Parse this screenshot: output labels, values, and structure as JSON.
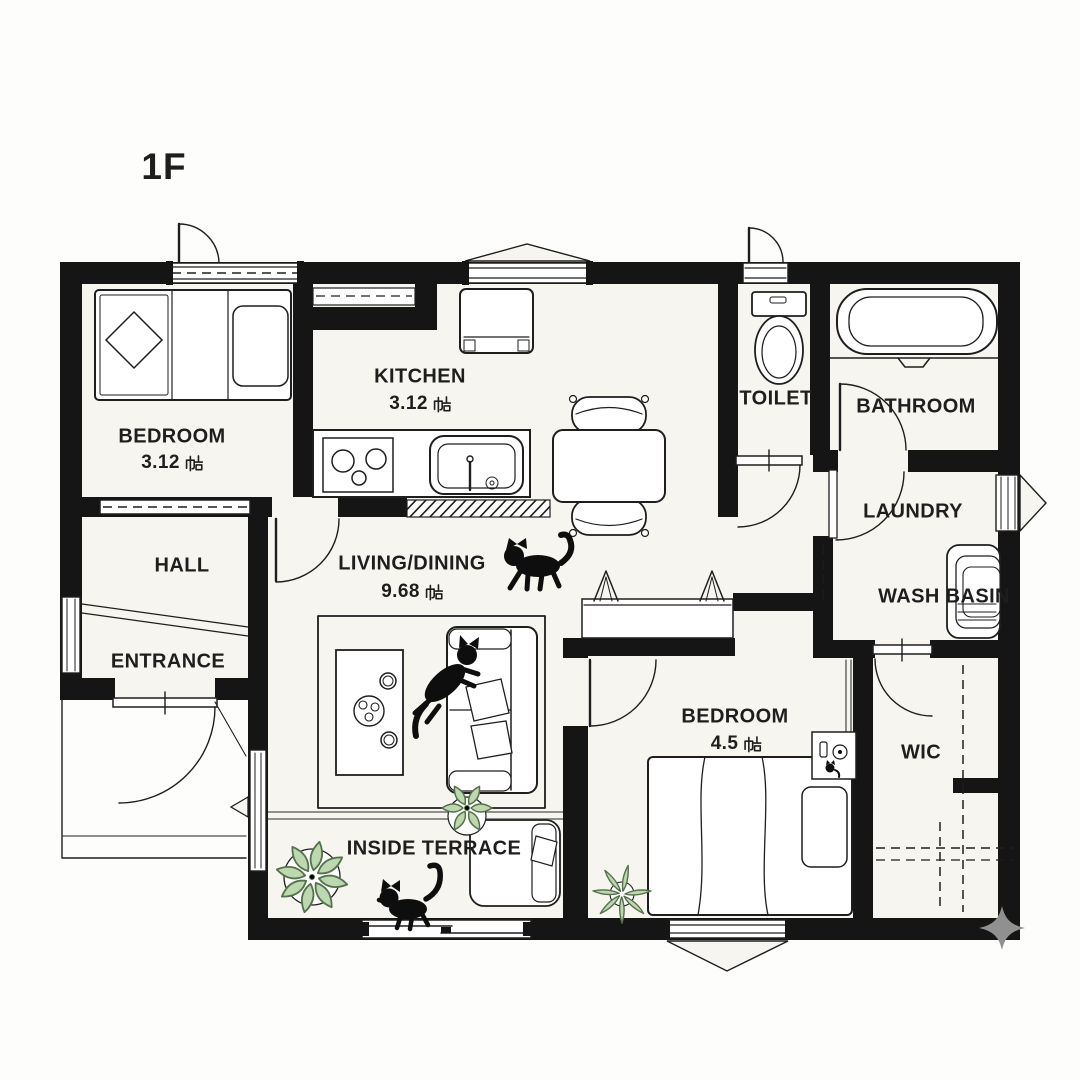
{
  "floor_label": "1F",
  "rooms": {
    "bedroom_1": {
      "name": "BEDROOM",
      "size_value": "3.12",
      "size_unit": "帖"
    },
    "kitchen": {
      "name": "KITCHEN",
      "size_value": "3.12",
      "size_unit": "帖"
    },
    "toilet": {
      "name": "TOILET"
    },
    "bathroom": {
      "name": "BATHROOM"
    },
    "laundry": {
      "name": "LAUNDRY"
    },
    "wash_basin": {
      "name": "WASH BASIN"
    },
    "hall": {
      "name": "HALL"
    },
    "entrance": {
      "name": "ENTRANCE"
    },
    "living_dining": {
      "name": "LIVING/DINING",
      "size_value": "9.68",
      "size_unit": "帖"
    },
    "inside_terrace": {
      "name": "INSIDE TERRACE"
    },
    "bedroom_2": {
      "name": "BEDROOM",
      "size_value": "4.5",
      "size_unit": "帖"
    },
    "wic": {
      "name": "WIC"
    }
  },
  "decorations": {
    "cats": [
      "walking-cat",
      "jumping-cat",
      "playing-kitten"
    ],
    "plants": [
      "round-leaf-plant",
      "star-leaf-plant",
      "spiky-leaf-plant"
    ],
    "corner_mark": "four-point-sparkle"
  },
  "colors": {
    "paper": "#fdfdfb",
    "floor": "#f6f5f0",
    "wall": "#151515",
    "line": "#1e1e1e",
    "furniture": "#ffffff",
    "plant_fill": "#bdd8b1",
    "plant_stroke": "#55714b",
    "cat": "#0e0e0e",
    "soft_line": "#8f8f8b",
    "sparkle": "#909090"
  }
}
